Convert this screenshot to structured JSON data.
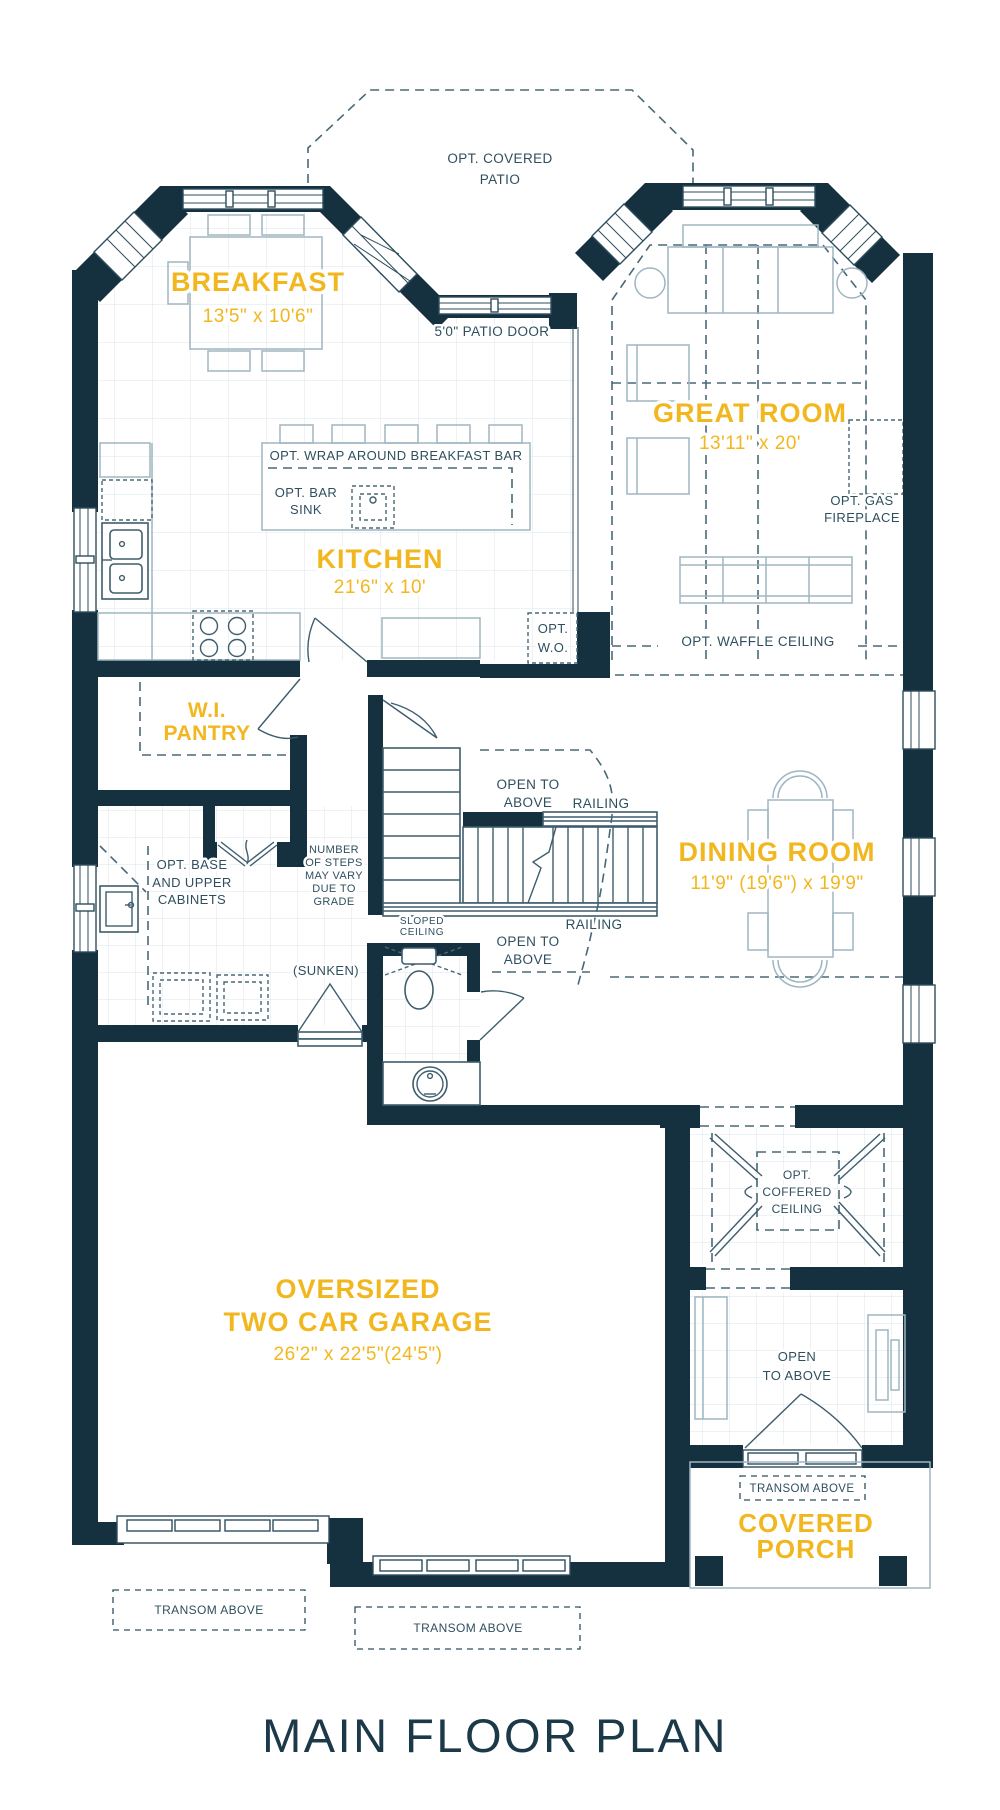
{
  "title": "MAIN FLOOR PLAN",
  "colors": {
    "wall": "#15303E",
    "accent_gold": "#F2B71E",
    "annotation": "#2F4F5E",
    "furniture_line": "#9FB5C1",
    "dashed_line": "#486877",
    "background": "#FFFFFF"
  },
  "rooms": {
    "breakfast": {
      "name": "BREAKFAST",
      "dims": "13'5\" x 10'6\""
    },
    "great_room": {
      "name": "GREAT ROOM",
      "dims": "13'11\" x 20'"
    },
    "kitchen": {
      "name": "KITCHEN",
      "dims": "21'6\" x 10'"
    },
    "pantry": {
      "line1": "W.I.",
      "line2": "PANTRY"
    },
    "dining_room": {
      "name": "DINING ROOM",
      "dims": "11'9\" (19'6\") x 19'9\""
    },
    "garage": {
      "line1": "OVERSIZED",
      "line2": "TWO CAR GARAGE",
      "dims": "26'2\" x 22'5\"(24'5\")"
    },
    "porch": {
      "line1": "COVERED",
      "line2": "PORCH"
    }
  },
  "annotations": {
    "covered_patio": [
      "OPT. COVERED",
      "PATIO"
    ],
    "patio_door": "5'0\" PATIO DOOR",
    "breakfast_bar": "OPT. WRAP AROUND BREAKFAST BAR",
    "bar_sink": [
      "OPT. BAR",
      "SINK"
    ],
    "gas_fireplace": [
      "OPT. GAS",
      "FIREPLACE"
    ],
    "walk_out": [
      "OPT.",
      "W.O."
    ],
    "waffle_ceiling": "OPT. WAFFLE CEILING",
    "open_above_stairs": [
      "OPEN TO",
      "ABOVE"
    ],
    "open_above_lower": [
      "OPEN TO",
      "ABOVE"
    ],
    "open_above_foyer": [
      "OPEN",
      "TO ABOVE"
    ],
    "railing_upper": "RAILING",
    "railing_lower": "RAILING",
    "sloped_ceiling": [
      "SLOPED",
      "CEILING"
    ],
    "base_cabinets": [
      "OPT. BASE",
      "AND UPPER",
      "CABINETS"
    ],
    "steps_note": [
      "NUMBER",
      "OF STEPS",
      "MAY VARY",
      "DUE TO",
      "GRADE"
    ],
    "sunken": "(SUNKEN)",
    "coffered_ceiling": [
      "OPT.",
      "COFFERED",
      "CEILING"
    ],
    "transom_porch": "TRANSOM ABOVE",
    "transom_garage_left": "TRANSOM ABOVE",
    "transom_garage_center": "TRANSOM ABOVE"
  }
}
